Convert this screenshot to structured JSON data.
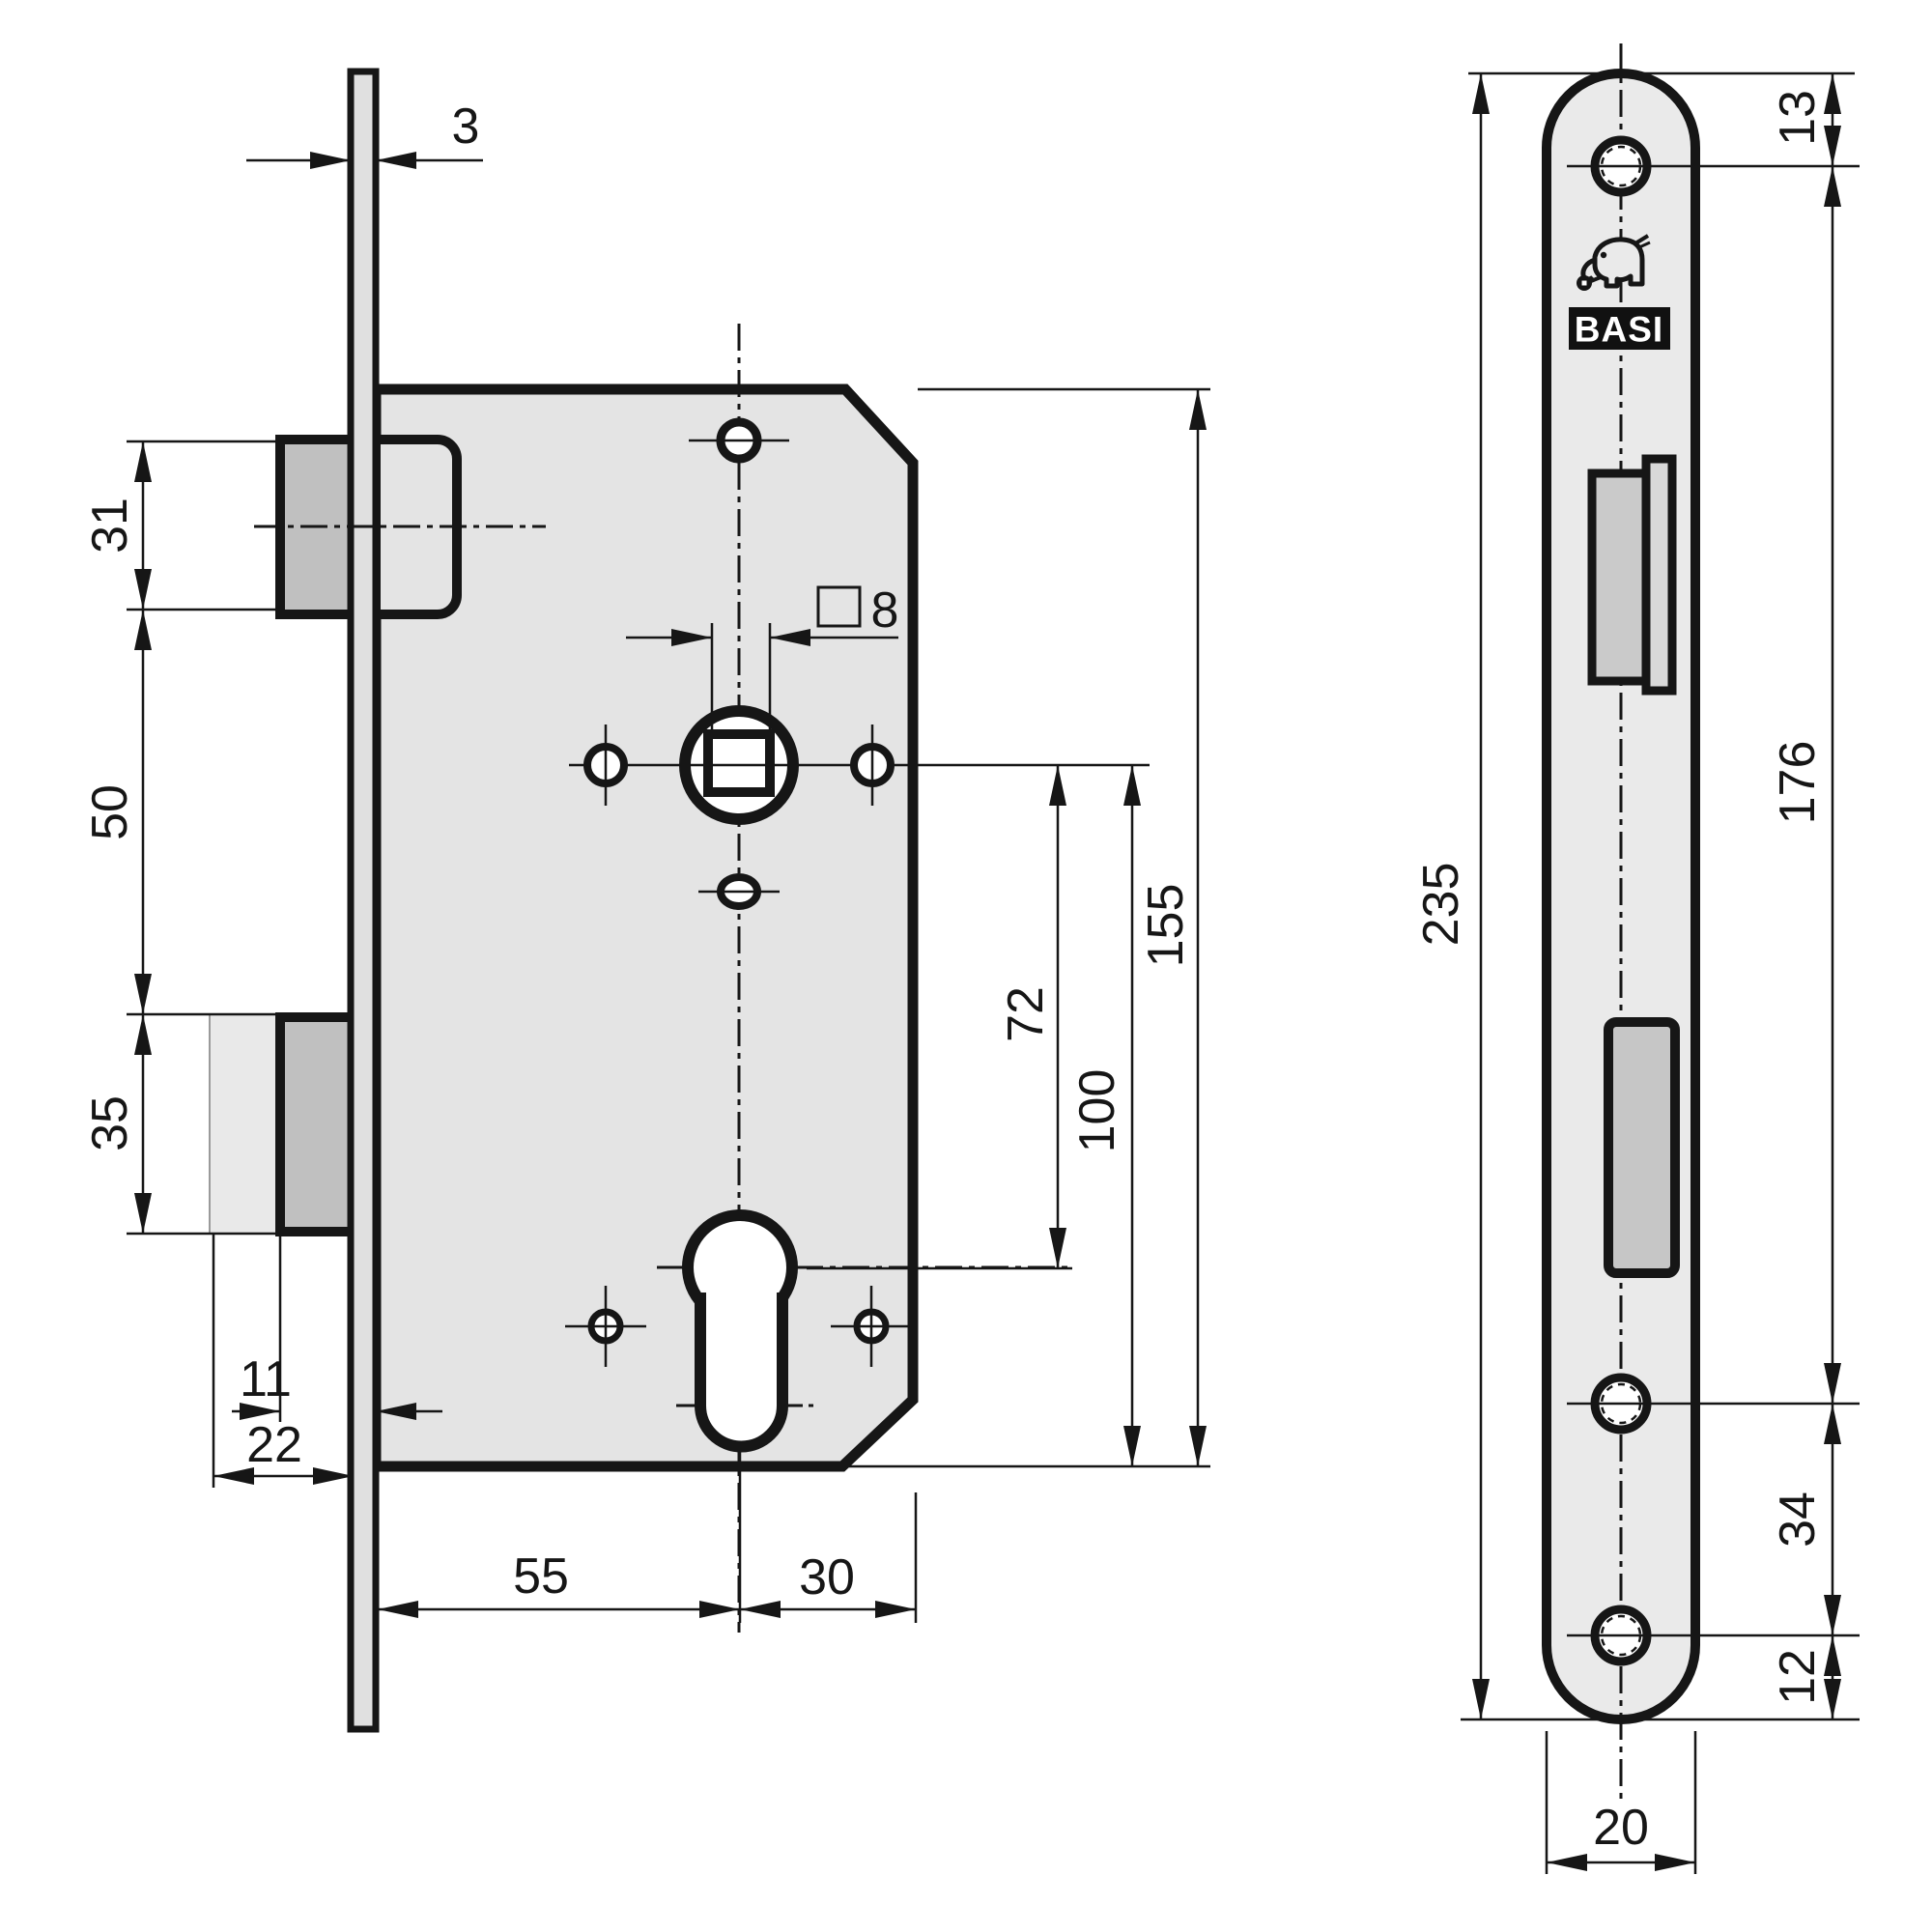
{
  "logo": {
    "brand": "BASI",
    "mark": "elephant-with-key-icon"
  },
  "colors": {
    "line": "#161616",
    "case_fill": "#e4e4e4",
    "faceplate_fill": "#e0e0e0",
    "front_plate_fill": "#eaeaea",
    "bolt_fill": "#c0c0c0",
    "ghost_bolt_fill": "#e9e9e9",
    "latch_cutout_fill": "#cacaca",
    "latch_tip_fill": "#d9d9d9",
    "deadbolt_cutout_fill": "#c6c6c6",
    "logo_box_fill": "#111111"
  },
  "dimensions": {
    "plate_thickness": "3",
    "latch_height": "31",
    "latch_to_deadbolt": "50",
    "deadbolt_height": "35",
    "bolt_throw_single": "11",
    "bolt_throw_double": "22",
    "backset": "55",
    "axis_to_case_back": "30",
    "spindle_square": "8",
    "handle_to_cylinder": "72",
    "handle_to_case_bottom": "100",
    "case_height": "155",
    "plate_top_to_hole": "13",
    "hole_spacing_main": "176",
    "plate_length": "235",
    "lower_hole_spacing": "34",
    "bottom_hole_to_end": "12",
    "plate_width": "20"
  }
}
